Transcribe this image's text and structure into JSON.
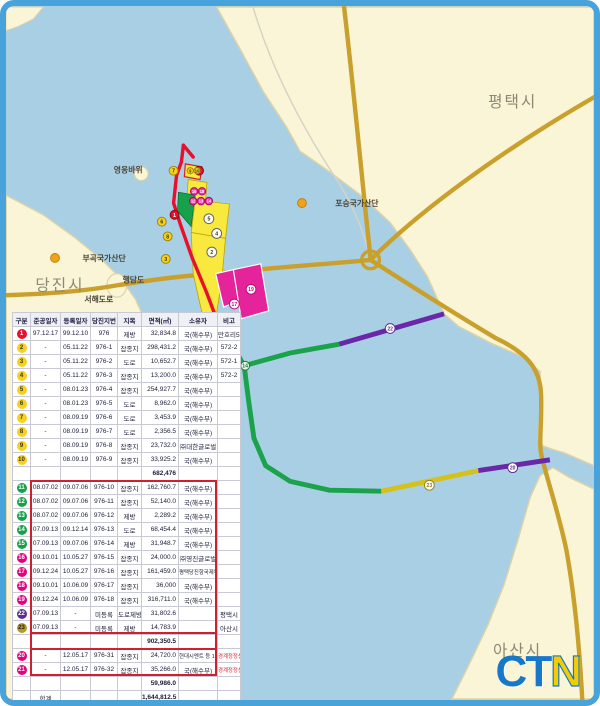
{
  "frame": {
    "border_color": "#48a3da"
  },
  "map": {
    "labels": [
      {
        "text": "평택시",
        "x": 492,
        "y": 102,
        "cls": "city"
      },
      {
        "text": "당진시",
        "x": 30,
        "y": 289,
        "cls": "city"
      },
      {
        "text": "아산시",
        "x": 497,
        "y": 662,
        "cls": "city"
      },
      {
        "text": "영웅바위",
        "x": 110,
        "y": 169,
        "cls": "small"
      },
      {
        "text": "포승국가산단",
        "x": 336,
        "y": 203,
        "cls": "small"
      },
      {
        "text": "부곡국가산단",
        "x": 78,
        "y": 259,
        "cls": "small"
      },
      {
        "text": "행담도",
        "x": 119,
        "y": 281,
        "cls": "small"
      },
      {
        "text": "서해도로",
        "x": 80,
        "y": 301,
        "cls": "small"
      }
    ],
    "industrial_dots": [
      {
        "x": 302,
        "y": 200
      },
      {
        "x": 50,
        "y": 256
      }
    ],
    "markers": [
      {
        "x": 197,
        "y": 167,
        "r": 4.5,
        "label": "1",
        "fill": "#e8112d",
        "ring": "#7e0a18",
        "fg": "#ffffff"
      },
      {
        "x": 171,
        "y": 167,
        "r": 4.5,
        "label": "7",
        "fill": "#f7d117",
        "ring": "#9a8610",
        "fg": "#333333"
      },
      {
        "x": 172,
        "y": 212,
        "r": 4.5,
        "label": "1",
        "fill": "#e8112d",
        "ring": "#7e0a18",
        "fg": "#ffffff"
      },
      {
        "x": 159,
        "y": 219,
        "r": 4.5,
        "label": "6",
        "fill": "#f7d117",
        "ring": "#9a8610",
        "fg": "#333333"
      },
      {
        "x": 165,
        "y": 234,
        "r": 4.5,
        "label": "8",
        "fill": "#f7d117",
        "ring": "#9a8610",
        "fg": "#333333"
      },
      {
        "x": 163,
        "y": 257,
        "r": 4.5,
        "label": "3",
        "fill": "#f7d117",
        "ring": "#9a8610",
        "fg": "#333333"
      },
      {
        "x": 188,
        "y": 167,
        "r": 3.2,
        "label": "9",
        "fill": "#f7d117",
        "ring": "#9a8610",
        "fg": "#333333"
      },
      {
        "x": 195,
        "y": 167,
        "r": 3.2,
        "label": "10",
        "fill": "#f7d117",
        "ring": "#9a8610",
        "fg": "#333333"
      },
      {
        "x": 192,
        "y": 188,
        "r": 3.8,
        "label": "16",
        "fill": "#ee3fa5",
        "ring": "#a60570",
        "fg": "#ffffff"
      },
      {
        "x": 200,
        "y": 188,
        "r": 3.8,
        "label": "18",
        "fill": "#ee3fa5",
        "ring": "#a60570",
        "fg": "#ffffff"
      },
      {
        "x": 191,
        "y": 198,
        "r": 3.8,
        "label": "12",
        "fill": "#ee3fa5",
        "ring": "#a60570",
        "fg": "#ffffff"
      },
      {
        "x": 199,
        "y": 198,
        "r": 3.8,
        "label": "13",
        "fill": "#ee3fa5",
        "ring": "#a60570",
        "fg": "#ffffff"
      },
      {
        "x": 207,
        "y": 198,
        "r": 3.8,
        "label": "14",
        "fill": "#ee3fa5",
        "ring": "#a60570",
        "fg": "#ffffff"
      },
      {
        "x": 207,
        "y": 216,
        "r": 5,
        "label": "5",
        "fill": "#fffdf0",
        "ring": "#666666",
        "fg": "#333333"
      },
      {
        "x": 215,
        "y": 231,
        "r": 5,
        "label": "4",
        "fill": "#fffdf0",
        "ring": "#666666",
        "fg": "#333333"
      },
      {
        "x": 210,
        "y": 250,
        "r": 5,
        "label": "2",
        "fill": "#fffdf0",
        "ring": "#666666",
        "fg": "#333333"
      },
      {
        "x": 233,
        "y": 303,
        "r": 5,
        "label": "17",
        "fill": "#ffffff",
        "ring": "#c4067f",
        "fg": "#c4067f"
      },
      {
        "x": 250,
        "y": 288,
        "r": 5,
        "label": "19",
        "fill": "#ffffff",
        "ring": "#c4067f",
        "fg": "#c4067f"
      },
      {
        "x": 244,
        "y": 366,
        "r": 4.5,
        "label": "14",
        "fill": "#eaf6e4",
        "ring": "#1a7a3a",
        "fg": "#1a7a3a"
      },
      {
        "x": 392,
        "y": 328,
        "r": 5,
        "label": "22",
        "fill": "#ffffff",
        "ring": "#5b2d8f",
        "fg": "#5b2d8f"
      },
      {
        "x": 432,
        "y": 488,
        "r": 5,
        "label": "23",
        "fill": "#ffffff",
        "ring": "#9a8610",
        "fg": "#8a7a10"
      },
      {
        "x": 517,
        "y": 470,
        "r": 5,
        "label": "20",
        "fill": "#ffffff",
        "ring": "#5b2d8f",
        "fg": "#5b2d8f"
      }
    ],
    "logo_letters": [
      {
        "ch": "C",
        "color": "#1777c9"
      },
      {
        "ch": "T",
        "color": "#1777c9"
      },
      {
        "ch": "N",
        "color": "#f4cd00"
      }
    ]
  },
  "table": {
    "headers": [
      "구분",
      "준공일자",
      "등록일자",
      "당진지번",
      "지목",
      "면적(㎡)",
      "소유자",
      "비고"
    ],
    "rows": [
      {
        "no": "1",
        "bg": "#e8112d",
        "fg": "#ffffff",
        "c": [
          "97.12.17",
          "99.12.10",
          "976",
          "제방",
          "32,834.8",
          "국(해수부)",
          "만호리572"
        ]
      },
      {
        "no": "2",
        "bg": "#f7d117",
        "fg": "#333333",
        "c": [
          "-",
          "05.11.22",
          "976-1",
          "잡종지",
          "298,431.2",
          "국(해수부)",
          "572-2"
        ]
      },
      {
        "no": "3",
        "bg": "#f7d117",
        "fg": "#333333",
        "c": [
          "-",
          "05.11.22",
          "976-2",
          "도로",
          "10,652.7",
          "국(해수부)",
          "572-1"
        ]
      },
      {
        "no": "4",
        "bg": "#f7d117",
        "fg": "#333333",
        "c": [
          "-",
          "05.11.22",
          "976-3",
          "잡종지",
          "13,200.0",
          "국(해수부)",
          "572-2"
        ]
      },
      {
        "no": "5",
        "bg": "#f7d117",
        "fg": "#333333",
        "c": [
          "-",
          "08.01.23",
          "976-4",
          "잡종지",
          "254,927.7",
          "국(해수부)",
          ""
        ]
      },
      {
        "no": "6",
        "bg": "#f7d117",
        "fg": "#333333",
        "c": [
          "-",
          "08.01.23",
          "976-5",
          "도로",
          "8,962.0",
          "국(해수부)",
          ""
        ]
      },
      {
        "no": "7",
        "bg": "#f7d117",
        "fg": "#333333",
        "c": [
          "-",
          "08.09.19",
          "976-6",
          "도로",
          "3,453.9",
          "국(해수부)",
          ""
        ]
      },
      {
        "no": "8",
        "bg": "#f7d117",
        "fg": "#333333",
        "c": [
          "-",
          "08.09.19",
          "976-7",
          "도로",
          "2,356.5",
          "국(해수부)",
          ""
        ]
      },
      {
        "no": "9",
        "bg": "#f7d117",
        "fg": "#333333",
        "c": [
          "-",
          "08.09.19",
          "976-8",
          "잡종지",
          "23,732.0",
          "㈜대한글로벌",
          ""
        ]
      },
      {
        "no": "10",
        "bg": "#f7d117",
        "fg": "#333333",
        "c": [
          "-",
          "08.09.19",
          "976-9",
          "잡종지",
          "33,925.2",
          "국(해수부)",
          ""
        ]
      },
      {
        "type": "sub",
        "area": "682,476"
      },
      {
        "no": "11",
        "bg": "#17a04b",
        "fg": "#ffffff",
        "c": [
          "08.07.02",
          "09.07.06",
          "976-10",
          "잡종지",
          "162,760.7",
          "국(해수부)",
          ""
        ]
      },
      {
        "no": "12",
        "bg": "#17a04b",
        "fg": "#ffffff",
        "c": [
          "08.07.02",
          "09.07.06",
          "976-11",
          "잡종지",
          "52,140.0",
          "국(해수부)",
          ""
        ]
      },
      {
        "no": "13",
        "bg": "#17a04b",
        "fg": "#ffffff",
        "c": [
          "08.07.02",
          "09.07.06",
          "976-12",
          "제방",
          "2,289.2",
          "국(해수부)",
          ""
        ]
      },
      {
        "no": "14",
        "bg": "#17a04b",
        "fg": "#ffffff",
        "c": [
          "07.09.13",
          "09.12.14",
          "976-13",
          "도로",
          "68,454.4",
          "국(해수부)",
          ""
        ]
      },
      {
        "no": "15",
        "bg": "#17a04b",
        "fg": "#ffffff",
        "c": [
          "07.09.13",
          "09.07.06",
          "976-14",
          "제방",
          "31,948.7",
          "국(해수부)",
          ""
        ]
      },
      {
        "no": "16",
        "bg": "#e5007e",
        "fg": "#ffffff",
        "c": [
          "09.10.01",
          "10.05.27",
          "976-15",
          "잡종지",
          "24,000.0",
          "㈜영진글로벌",
          ""
        ]
      },
      {
        "no": "17",
        "bg": "#e5007e",
        "fg": "#ffffff",
        "c": [
          "09.12.24",
          "10.05.27",
          "976-16",
          "잡종지",
          "161,459.0",
          "평택당진항국제부두",
          ""
        ]
      },
      {
        "no": "18",
        "bg": "#e5007e",
        "fg": "#ffffff",
        "c": [
          "09.10.01",
          "10.06.09",
          "976-17",
          "잡종지",
          "36,000",
          "국(해수부)",
          ""
        ]
      },
      {
        "no": "19",
        "bg": "#e5007e",
        "fg": "#ffffff",
        "c": [
          "09.12.24",
          "10.06.09",
          "976-18",
          "잡종지",
          "316,711.0",
          "국(해수부)",
          ""
        ]
      },
      {
        "no": "22",
        "bg": "#5b2d8f",
        "fg": "#ffffff",
        "c": [
          "07.09.13",
          "-",
          "미등록",
          "도로제방",
          "31,802.6",
          "",
          "평택시"
        ]
      },
      {
        "no": "23",
        "bg": "#b5992a",
        "fg": "#222222",
        "c": [
          "07.09.13",
          "-",
          "미등록",
          "제방",
          "14,783.9",
          "",
          "아산시"
        ]
      },
      {
        "type": "sub",
        "area": "902,350.5"
      },
      {
        "no": "20",
        "bg": "#e5007e",
        "fg": "#ffffff",
        "remark_red": true,
        "c": [
          "-",
          "12.05.17",
          "976-31",
          "잡종지",
          "24,720.0",
          "현대시멘트 등 12",
          "경계정정신청"
        ]
      },
      {
        "no": "21",
        "bg": "#e5007e",
        "fg": "#ffffff",
        "remark_red": true,
        "c": [
          "-",
          "12.05.17",
          "976-32",
          "잡종지",
          "35,266.0",
          "국(해수부)",
          "경계정정신청"
        ]
      },
      {
        "type": "sub",
        "area": "59,986.0"
      },
      {
        "type": "total",
        "label": "합계",
        "area": "1,644,812.5"
      }
    ]
  }
}
